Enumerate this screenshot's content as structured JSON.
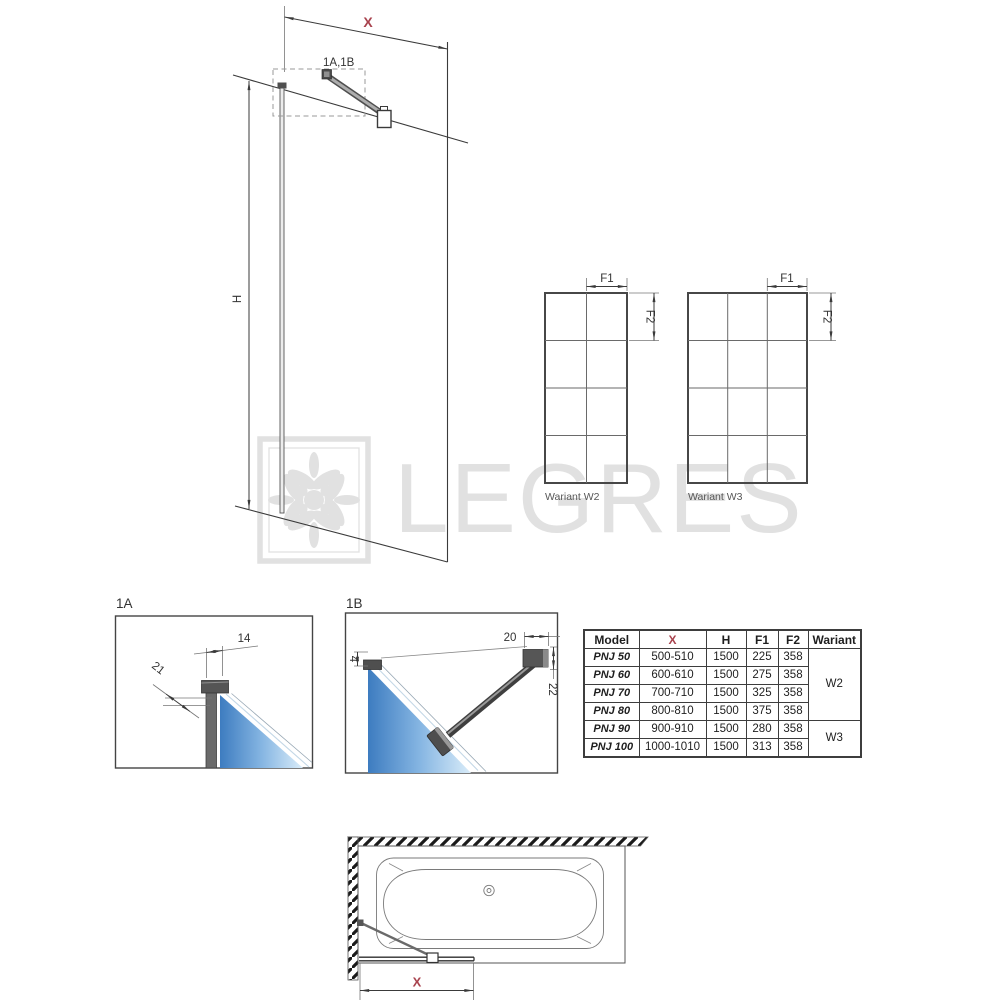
{
  "watermark": {
    "brand": "LEGRES",
    "logo": "floral-ornament"
  },
  "colors": {
    "dimension_red": "#a8424d",
    "line_dark": "#3a3a3a",
    "glass_blue_dark": "#3d7cc0",
    "glass_blue_light": "#d9ecf9",
    "watermark_gray": "#e1e1e1"
  },
  "elevation": {
    "width_dim": "X",
    "height_dim": "H",
    "detail_callout": "1A,1B"
  },
  "variants": {
    "w2": {
      "label": "Wariant W2",
      "f1_dim": "F1",
      "f2_dim": "F2"
    },
    "w3": {
      "label": "Wariant W3",
      "f1_dim": "F1",
      "f2_dim": "F2"
    }
  },
  "details": {
    "a": {
      "label": "1A",
      "dim_width": "14",
      "dim_diagonal": "21"
    },
    "b": {
      "label": "1B",
      "dim_gap": "4",
      "dim_bracket_width": "20",
      "dim_bracket_height": "22"
    }
  },
  "top_view": {
    "width_dim": "X"
  },
  "table": {
    "headers": {
      "model": "Model",
      "x": "X",
      "h": "H",
      "f1": "F1",
      "f2": "F2",
      "wariant": "Wariant"
    },
    "rows": [
      {
        "model": "PNJ 50",
        "x": "500-510",
        "h": "1500",
        "f1": "225",
        "f2": "358"
      },
      {
        "model": "PNJ 60",
        "x": "600-610",
        "h": "1500",
        "f1": "275",
        "f2": "358"
      },
      {
        "model": "PNJ 70",
        "x": "700-710",
        "h": "1500",
        "f1": "325",
        "f2": "358"
      },
      {
        "model": "PNJ 80",
        "x": "800-810",
        "h": "1500",
        "f1": "375",
        "f2": "358"
      },
      {
        "model": "PNJ 90",
        "x": "900-910",
        "h": "1500",
        "f1": "280",
        "f2": "358"
      },
      {
        "model": "PNJ 100",
        "x": "1000-1010",
        "h": "1500",
        "f1": "313",
        "f2": "358"
      }
    ],
    "wariant_groups": [
      {
        "label": "W2"
      },
      {
        "label": "W3"
      }
    ]
  }
}
